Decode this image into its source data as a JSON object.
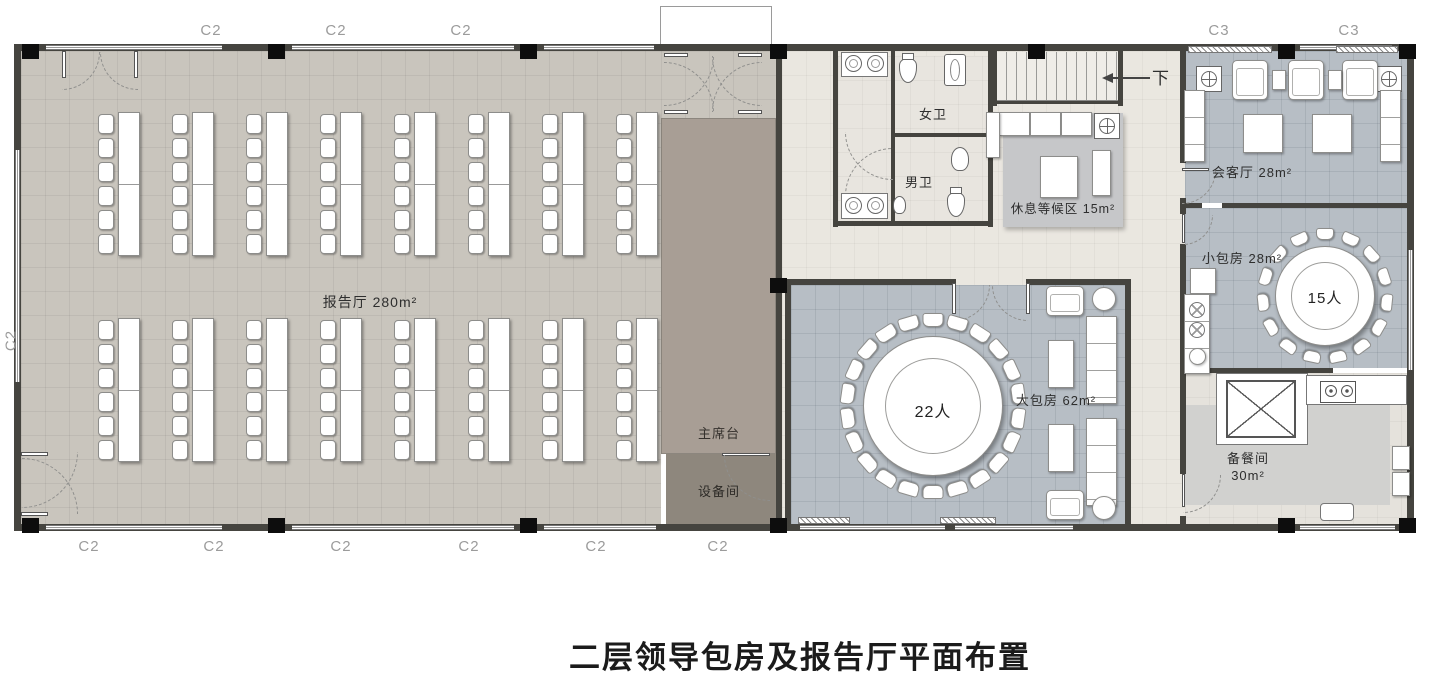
{
  "title": "二层领导包房及报告厅平面布置",
  "rooms": {
    "lecture_hall": {
      "label": "报告厅 280m²"
    },
    "stage": {
      "label": "主席台"
    },
    "equipment_room": {
      "label": "设备间"
    },
    "womens_wc": {
      "label": "女卫"
    },
    "mens_wc": {
      "label": "男卫"
    },
    "waiting_area": {
      "label": "休息等候区 15m²"
    },
    "reception_room": {
      "label": "会客厅 28m²"
    },
    "small_private_room": {
      "label": "小包房 28m²",
      "capacity": "15人"
    },
    "large_private_room": {
      "label": "大包房 62m²",
      "capacity": "22人"
    },
    "pantry": {
      "label": "备餐间",
      "area": "30m²"
    }
  },
  "annotations": {
    "stair_down": "下"
  },
  "grid_labels": {
    "top": [
      "C2",
      "C2",
      "C2"
    ],
    "top_right": [
      "C3",
      "C3"
    ],
    "bottom": [
      "C2",
      "C2",
      "C2",
      "C2",
      "C2",
      "C2"
    ],
    "left": "C2"
  },
  "colors": {
    "hall_floor": "#c9c5bd",
    "stage_floor": "#a89e95",
    "equipment_floor": "#8e877d",
    "corridor_floor": "#eae7e0",
    "dining_floor": "#b7bec5",
    "pantry_floor": "#e5e2dc",
    "rug": "#c6c7c9",
    "pantry_rug": "#d1d1cf",
    "wall": "#45443f",
    "column": "#0d0d0d"
  }
}
